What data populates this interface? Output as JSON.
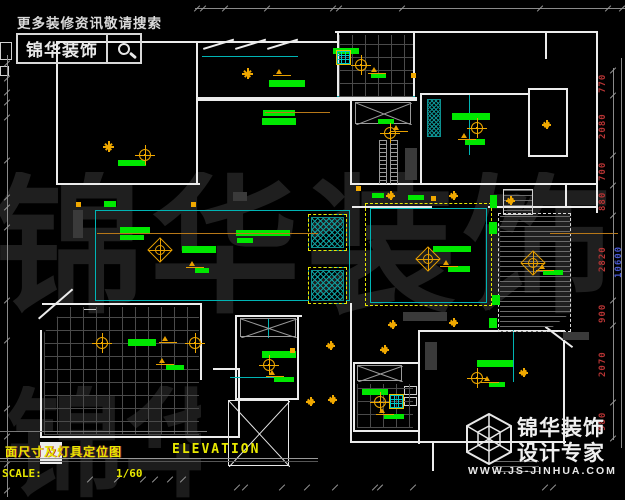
{
  "promo": {
    "slogan": "更多装修资讯敬请搜索",
    "brand": "锦华装饰",
    "search_icon": "magnifier"
  },
  "watermark": {
    "row1": "锦华装饰",
    "row2": "锦华装饰"
  },
  "title_block": {
    "title_cn": "面尺寸及灯具定位图",
    "title_en": "ELEVATION",
    "scale_label": "SCALE:",
    "scale_value": "1/60"
  },
  "footer": {
    "brand_line1": "锦华装饰",
    "brand_line2": "设计专家",
    "website": "WWW.JS-JINHUA.COM",
    "logo_icon": "wireframe-cube"
  },
  "colors": {
    "label_green": "#00e800",
    "light_orange": "#f0a800",
    "wall_white": "#ececec",
    "cad_cyan": "#00b4b4",
    "dashed_yellow": "#e8e800",
    "dim_red": "#b63434",
    "dim_blue": "#4a5ad2",
    "title_yellow": "#e8e800"
  },
  "dimensions": {
    "right_chain": {
      "line": [
        613,
        68,
        1,
        372
      ],
      "ticks": [
        70,
        95,
        155,
        185,
        215,
        300,
        325,
        402,
        438
      ],
      "labels": [
        {
          "v": "770",
          "y": 82
        },
        {
          "v": "2080",
          "y": 125
        },
        {
          "v": "700",
          "y": 170
        },
        {
          "v": "880",
          "y": 200
        },
        {
          "v": "2820",
          "y": 258
        },
        {
          "v": "900",
          "y": 312
        },
        {
          "v": "2070",
          "y": 363
        },
        {
          "v": "980",
          "y": 420
        }
      ],
      "outer_line": [
        621,
        58,
        1,
        390
      ],
      "outer_label": {
        "v": "10600",
        "x": 614,
        "y": 240
      }
    },
    "top": {
      "line": [
        195,
        8,
        430,
        1
      ],
      "y": 8,
      "tick_xs": [
        197,
        203,
        225,
        267,
        333,
        339,
        402,
        540,
        608,
        622
      ]
    },
    "left": {
      "line": [
        7,
        55,
        1,
        442
      ],
      "x": 3,
      "tick_ys": [
        63,
        78,
        92,
        102,
        117,
        160,
        197,
        207,
        227,
        300,
        340,
        408,
        436,
        464,
        490
      ]
    },
    "bottom": {
      "rows": [
        {
          "y": 479,
          "xs": [
            90,
            117,
            143,
            155,
            170,
            183
          ]
        },
        {
          "y": 487,
          "xs": [
            237,
            245,
            282,
            307,
            335,
            375,
            380,
            413,
            545,
            553
          ]
        }
      ]
    }
  },
  "plan": {
    "walls": [
      [
        335,
        31,
        263,
        2
      ],
      [
        596,
        31,
        2,
        182
      ],
      [
        56,
        41,
        146,
        2
      ],
      [
        56,
        41,
        2,
        144
      ],
      [
        196,
        41,
        2,
        59
      ],
      [
        198,
        41,
        141,
        2
      ],
      [
        337,
        33,
        2,
        65
      ],
      [
        413,
        33,
        2,
        65
      ],
      [
        196,
        97,
        221,
        4
      ],
      [
        56,
        183,
        144,
        2
      ],
      [
        196,
        101,
        2,
        84
      ],
      [
        350,
        101,
        2,
        84
      ],
      [
        352,
        183,
        246,
        2
      ],
      [
        352,
        206,
        80,
        2
      ],
      [
        488,
        206,
        110,
        2
      ],
      [
        420,
        93,
        2,
        92
      ],
      [
        422,
        93,
        108,
        2
      ],
      [
        528,
        88,
        40,
        2
      ],
      [
        528,
        88,
        2,
        69
      ],
      [
        566,
        88,
        2,
        69
      ],
      [
        528,
        155,
        40,
        2
      ],
      [
        545,
        31,
        2,
        28
      ],
      [
        350,
        303,
        2,
        140
      ],
      [
        42,
        303,
        160,
        2
      ],
      [
        40,
        330,
        2,
        108
      ],
      [
        40,
        436,
        200,
        2
      ],
      [
        200,
        305,
        2,
        75
      ],
      [
        213,
        368,
        27,
        2
      ],
      [
        238,
        368,
        2,
        70
      ],
      [
        235,
        315,
        67,
        2
      ],
      [
        235,
        315,
        2,
        85
      ],
      [
        297,
        315,
        2,
        85
      ],
      [
        235,
        398,
        64,
        2
      ],
      [
        353,
        362,
        67,
        2
      ],
      [
        353,
        362,
        2,
        70
      ],
      [
        418,
        362,
        2,
        70
      ],
      [
        353,
        430,
        67,
        2
      ],
      [
        418,
        330,
        2,
        114
      ],
      [
        418,
        330,
        147,
        2
      ],
      [
        563,
        330,
        2,
        114
      ],
      [
        352,
        441,
        214,
        2
      ],
      [
        432,
        443,
        2,
        28
      ],
      [
        565,
        183,
        33,
        2
      ],
      [
        565,
        183,
        2,
        25
      ],
      [
        40,
        442,
        22,
        22
      ]
    ],
    "wallboxes": [
      [
        0,
        42,
        12,
        18
      ],
      [
        0,
        66,
        9,
        10
      ],
      [
        404,
        386,
        13,
        9
      ],
      [
        404,
        397,
        13,
        9
      ],
      [
        83,
        309,
        14,
        9
      ],
      [
        503,
        189,
        30,
        26
      ]
    ],
    "diag_walls": [
      [
        38,
        318,
        45,
        -41
      ],
      [
        546,
        326,
        34,
        37
      ],
      [
        203,
        48,
        32,
        -17
      ],
      [
        235,
        48,
        32,
        -17
      ],
      [
        267,
        48,
        32,
        -17
      ]
    ],
    "cyan": [
      [
        202,
        56,
        96,
        1
      ],
      [
        95,
        210,
        255,
        1
      ],
      [
        95,
        210,
        1,
        91
      ],
      [
        95,
        300,
        255,
        1
      ],
      [
        349,
        210,
        1,
        91
      ],
      [
        370,
        208,
        1,
        95
      ],
      [
        370,
        208,
        117,
        1
      ],
      [
        370,
        302,
        117,
        1
      ],
      [
        486,
        208,
        1,
        95
      ],
      [
        230,
        377,
        48,
        1
      ],
      [
        513,
        330,
        1,
        52
      ],
      [
        469,
        95,
        1,
        60
      ],
      [
        337,
        96,
        78,
        1
      ],
      [
        268,
        318,
        1,
        20
      ]
    ],
    "grids": [
      {
        "r": [
          44,
          307,
          155,
          128
        ],
        "clip": "polygon(0 20%,14% 0,100% 0,100% 100%,0 100%)"
      },
      {
        "r": [
          339,
          35,
          74,
          62
        ]
      },
      {
        "r": [
          357,
          384,
          56,
          44
        ]
      }
    ],
    "stripes": [
      {
        "r": [
          500,
          216,
          70,
          116
        ],
        "clip": "polygon(0 0,100% 0,100% 84%,66% 100%,0 100%)"
      },
      {
        "r": [
          504,
          190,
          28,
          24
        ]
      },
      {
        "r": [
          493,
          461,
          46,
          14
        ]
      }
    ],
    "ladders": [
      [
        379,
        140,
        8,
        44
      ],
      [
        390,
        140,
        8,
        44
      ]
    ],
    "tealhatch": [
      [
        427,
        99,
        14,
        38
      ]
    ],
    "ydash": [
      [
        365,
        203,
        127,
        103
      ]
    ],
    "wdash": [
      [
        498,
        213,
        73,
        119
      ]
    ],
    "hsq": [
      [
        308,
        214,
        39,
        37
      ],
      [
        308,
        267,
        39,
        37
      ]
    ],
    "xboxes": [
      {
        "r": [
          240,
          318,
          56,
          19
        ],
        "c": "#9a9a9a"
      },
      {
        "r": [
          355,
          102,
          56,
          22
        ],
        "c": "#9a9a9a"
      },
      {
        "r": [
          357,
          365,
          45,
          16
        ],
        "c": "#9a9a9a"
      },
      {
        "r": [
          228,
          400,
          61,
          66
        ],
        "c": "#e8e8e8"
      }
    ],
    "green_bars": [
      [
        333,
        48,
        26,
        6
      ],
      [
        371,
        73,
        15,
        5
      ],
      [
        269,
        80,
        36,
        7
      ],
      [
        263,
        110,
        32,
        6
      ],
      [
        262,
        118,
        34,
        7
      ],
      [
        452,
        113,
        38,
        7
      ],
      [
        465,
        139,
        20,
        6
      ],
      [
        118,
        160,
        28,
        6
      ],
      [
        104,
        201,
        12,
        6
      ],
      [
        120,
        227,
        30,
        6
      ],
      [
        120,
        235,
        24,
        5
      ],
      [
        182,
        246,
        34,
        7
      ],
      [
        195,
        268,
        14,
        5
      ],
      [
        236,
        230,
        54,
        6
      ],
      [
        237,
        238,
        16,
        5
      ],
      [
        433,
        246,
        38,
        6
      ],
      [
        448,
        266,
        22,
        6
      ],
      [
        128,
        339,
        28,
        7
      ],
      [
        166,
        365,
        18,
        5
      ],
      [
        262,
        351,
        34,
        7
      ],
      [
        274,
        377,
        20,
        5
      ],
      [
        362,
        389,
        26,
        6
      ],
      [
        384,
        414,
        20,
        5
      ],
      [
        477,
        360,
        36,
        7
      ],
      [
        489,
        382,
        16,
        5
      ],
      [
        372,
        193,
        12,
        5
      ],
      [
        408,
        195,
        16,
        5
      ],
      [
        490,
        195,
        7,
        13
      ],
      [
        543,
        270,
        20,
        5
      ],
      [
        378,
        119,
        16,
        5
      ],
      [
        489,
        222,
        8,
        12
      ],
      [
        492,
        295,
        8,
        10
      ],
      [
        489,
        318,
        8,
        10
      ]
    ],
    "gray_blobs": [
      [
        403,
        312,
        44,
        9
      ],
      [
        563,
        332,
        26,
        8
      ],
      [
        425,
        342,
        12,
        28
      ],
      [
        405,
        148,
        12,
        32
      ],
      [
        233,
        192,
        14,
        9
      ],
      [
        73,
        210,
        10,
        28
      ]
    ],
    "leaders": [
      [
        265,
        112,
        65
      ],
      [
        97,
        233,
        221
      ],
      [
        550,
        233,
        68
      ]
    ],
    "lights": {
      "targets": [
        [
          361,
          65
        ],
        [
          145,
          155
        ],
        [
          390,
          133
        ],
        [
          477,
          128
        ],
        [
          102,
          343
        ],
        [
          195,
          343
        ],
        [
          269,
          365
        ],
        [
          380,
          402
        ],
        [
          477,
          378
        ]
      ],
      "chandeliers": [
        [
          160,
          250
        ],
        [
          428,
          259
        ],
        [
          533,
          263
        ]
      ],
      "flowers": [
        [
          247,
          73
        ],
        [
          108,
          146
        ]
      ],
      "stars": [
        [
          546,
          124
        ],
        [
          390,
          195
        ],
        [
          453,
          195
        ],
        [
          510,
          200
        ],
        [
          330,
          345
        ],
        [
          384,
          349
        ],
        [
          392,
          324
        ],
        [
          310,
          401
        ],
        [
          332,
          399
        ],
        [
          453,
          322
        ],
        [
          523,
          372
        ]
      ],
      "squares": [
        [
          78,
          204
        ],
        [
          193,
          204
        ],
        [
          433,
          198
        ],
        [
          292,
          350
        ],
        [
          358,
          188
        ],
        [
          413,
          75
        ]
      ],
      "brackets": [
        [
          368,
          66
        ],
        [
          458,
          132
        ],
        [
          186,
          260
        ],
        [
          440,
          259
        ],
        [
          156,
          357
        ],
        [
          266,
          369
        ],
        [
          376,
          407
        ],
        [
          481,
          375
        ],
        [
          536,
          263
        ],
        [
          390,
          124
        ],
        [
          273,
          68
        ],
        [
          159,
          335
        ]
      ]
    },
    "fans": [
      [
        336,
        50
      ],
      [
        389,
        394
      ]
    ]
  }
}
